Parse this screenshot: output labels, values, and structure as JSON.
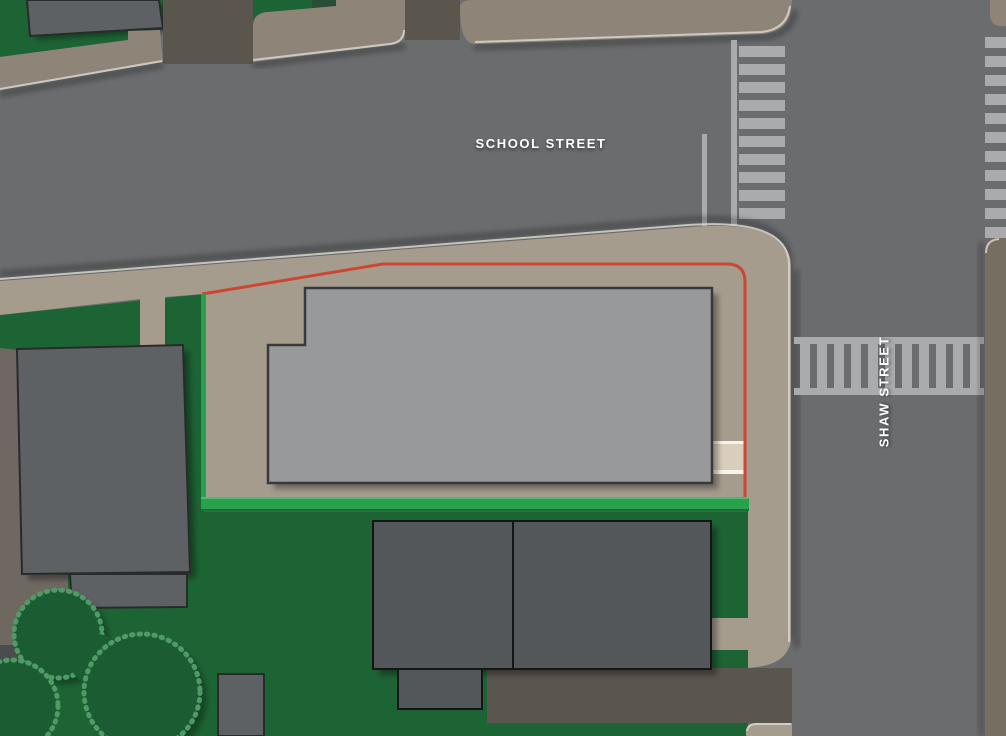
{
  "labels": {
    "school_street": "SCHOOL STREET",
    "shaw_street": "SHAW STREET"
  },
  "colors": {
    "road": "#6a6c6e",
    "sidewalk-north": "#8e8578",
    "sidewalk-south": "#a69c8e",
    "curb-east": "#756e61",
    "grass": "#1d6434",
    "tree": "#1c5c32",
    "tree-edge": "#4f9a66",
    "olive-ground": "#6e6860",
    "driveway": "#5b564d",
    "building-main": "#97999b",
    "building-dark": "#54575a",
    "building-mid": "#5e6163",
    "parcel-line-red": "#cd4533",
    "parcel-line-green": "#28a14d",
    "crosswalk": "#a9abad",
    "cream-walk": "#d9cdbb",
    "curb-highlight": "#d8d5cd",
    "dark-strip": "#4a4c4e",
    "label-text": "#ffffff"
  }
}
